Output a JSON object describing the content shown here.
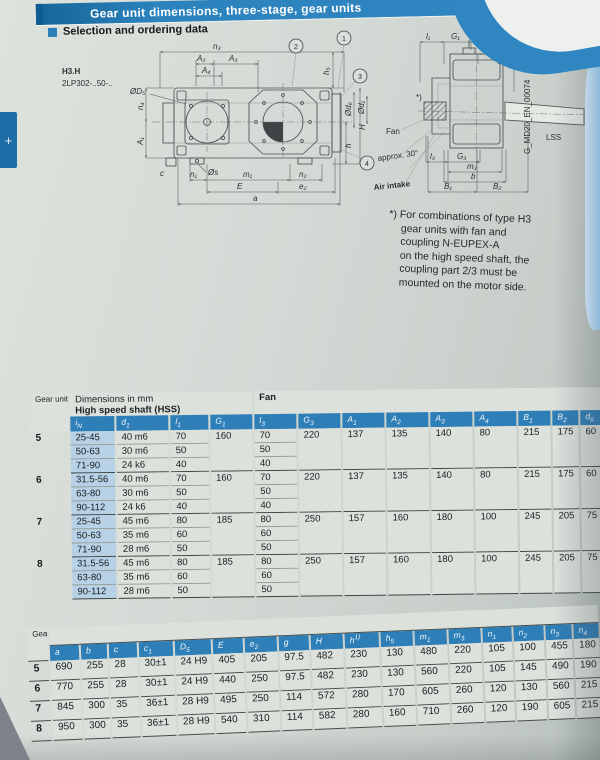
{
  "banner": {
    "title": "Gear unit dimensions, three-stage, gear units"
  },
  "section_title": "Selection and ordering data",
  "side_tab": {
    "glyph": "+"
  },
  "drawing": {
    "model_type": "H3.H",
    "model_code": "2LP302-..50-..",
    "callouts": [
      "1",
      "2",
      "3",
      "4"
    ],
    "plan": {
      "n3": "n₃",
      "A2": "A₂",
      "A3": "A₃",
      "A4": "A₄",
      "D5": "ØD₅",
      "n4": "n₄",
      "A1": "A₁",
      "s": "Øs",
      "c": "c",
      "n1": "n₁",
      "m1": "m₁",
      "n2": "n₂",
      "E": "E",
      "e2": "e₂",
      "a": "a",
      "h": "h",
      "H": "H",
      "h5": "h₅"
    },
    "fan": {
      "l1_left": "l₁",
      "G1_left": "G₁",
      "G1_right": "G₁",
      "l1_right": "l₁",
      "g": "g",
      "c1": "c₁",
      "d6": "Ød₆",
      "d1": "Ød₁",
      "l3": "l₃",
      "G3": "G₃",
      "m3": "m₃",
      "b": "b",
      "B1": "B₁",
      "B2": "B₂",
      "fan": "Fan",
      "approx": "approx. 30°",
      "air": "Air intake",
      "lss": "LSS",
      "star": "*)",
      "doc": "G_MD20_EN_00074"
    }
  },
  "footnote_lines": [
    "*) For combinations of type H3",
    "gear units with fan and",
    "coupling N-EUPEX-A",
    "on the high speed shaft, the",
    "coupling part 2/3 must be",
    "mounted on the motor side."
  ],
  "table1": {
    "corner": "Gear unit size",
    "dims_heading": "Dimensions in mm",
    "hss_heading": "High speed shaft (HSS)",
    "fan_heading": "Fan",
    "headers": [
      "i_N",
      "d_1",
      "l_1",
      "G_1",
      "l_3",
      "G_3",
      "A_1",
      "A_2",
      "A_3",
      "A_4",
      "B_1",
      "B_2",
      "d_6"
    ],
    "groups": [
      {
        "size": "5",
        "rows": [
          [
            "25-45",
            "40 m6",
            "70",
            "70"
          ],
          [
            "50-63",
            "30 m6",
            "50",
            "50"
          ],
          [
            "71-90",
            "24 k6",
            "40",
            "40"
          ]
        ],
        "merged": [
          "160",
          "220",
          "137",
          "135",
          "140",
          "80",
          "215",
          "175",
          "60"
        ]
      },
      {
        "size": "6",
        "rows": [
          [
            "31.5-56",
            "40 m6",
            "70",
            "70"
          ],
          [
            "63-80",
            "30 m6",
            "50",
            "50"
          ],
          [
            "90-112",
            "24 k6",
            "40",
            "40"
          ]
        ],
        "merged": [
          "160",
          "220",
          "137",
          "135",
          "140",
          "80",
          "215",
          "175",
          "60"
        ]
      },
      {
        "size": "7",
        "rows": [
          [
            "25-45",
            "45 m6",
            "80",
            "80"
          ],
          [
            "50-63",
            "35 m6",
            "60",
            "60"
          ],
          [
            "71-90",
            "28 m6",
            "50",
            "50"
          ]
        ],
        "merged": [
          "185",
          "250",
          "157",
          "160",
          "180",
          "100",
          "245",
          "205",
          "75"
        ]
      },
      {
        "size": "8",
        "rows": [
          [
            "31.5-56",
            "45 m6",
            "80",
            "80"
          ],
          [
            "63-80",
            "35 m6",
            "60",
            "60"
          ],
          [
            "90-112",
            "28 m6",
            "50",
            "50"
          ]
        ],
        "merged": [
          "185",
          "250",
          "157",
          "160",
          "180",
          "100",
          "245",
          "205",
          "75"
        ]
      }
    ]
  },
  "table2": {
    "corner": "Gear unit size",
    "headers": [
      "a",
      "b",
      "c",
      "c_1",
      "D_5",
      "E",
      "e_2",
      "g",
      "H",
      "h^1)",
      "h_5",
      "m_1",
      "m_3",
      "n_1",
      "n_2",
      "n_3",
      "n_4"
    ],
    "rows": [
      {
        "size": "5",
        "values": [
          "690",
          "255",
          "28",
          "30±1",
          "24 H9",
          "405",
          "205",
          "97.5",
          "482",
          "230",
          "130",
          "480",
          "220",
          "105",
          "100",
          "455",
          "180"
        ]
      },
      {
        "size": "6",
        "values": [
          "770",
          "255",
          "28",
          "30±1",
          "24 H9",
          "440",
          "250",
          "97.5",
          "482",
          "230",
          "130",
          "560",
          "220",
          "105",
          "145",
          "490",
          "190"
        ]
      },
      {
        "size": "7",
        "values": [
          "845",
          "300",
          "35",
          "36±1",
          "28 H9",
          "495",
          "250",
          "114",
          "572",
          "280",
          "170",
          "605",
          "260",
          "120",
          "130",
          "560",
          "215"
        ]
      },
      {
        "size": "8",
        "values": [
          "950",
          "300",
          "35",
          "36±1",
          "28 H9",
          "540",
          "310",
          "114",
          "582",
          "280",
          "160",
          "710",
          "260",
          "120",
          "190",
          "605",
          "215"
        ]
      }
    ]
  },
  "colors": {
    "banner_blue": "#2f86c0",
    "header_blue": "#2e7eb8",
    "band_blue": "#a9c9e1",
    "cell_blue": "#b7d2e6",
    "page": "#d3d9d4"
  }
}
